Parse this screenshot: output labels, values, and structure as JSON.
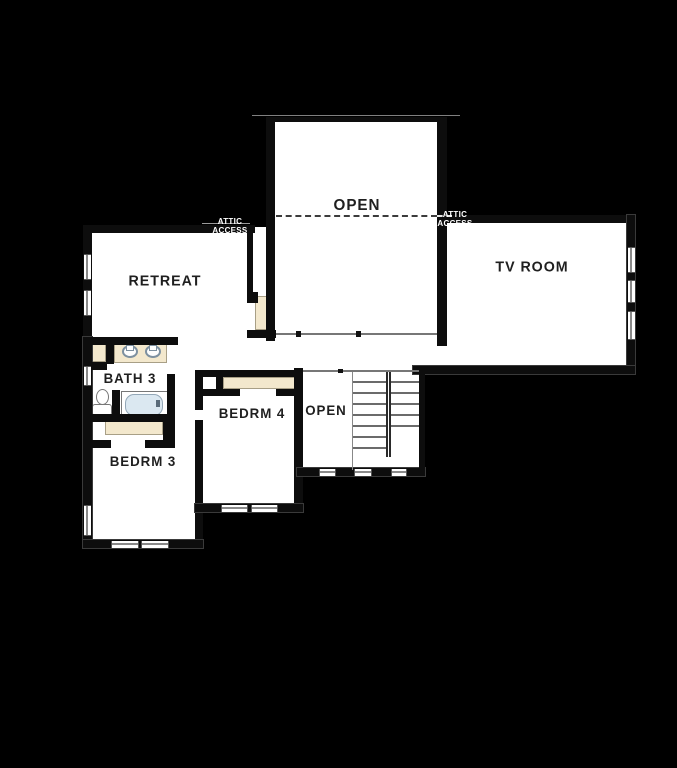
{
  "plan": {
    "type": "floor-plan-second-story",
    "colors": {
      "background": "#000000",
      "floor": "#ffffff",
      "wall": "#0d0d0d",
      "trim_beige": "#f3e8cd",
      "tub_fill": "#dbe8f1",
      "fixture_line": "#7d90a0"
    },
    "rooms": [
      {
        "id": "open-upper",
        "label": "OPEN"
      },
      {
        "id": "tv-room",
        "label": "TV ROOM"
      },
      {
        "id": "retreat",
        "label": "RETREAT"
      },
      {
        "id": "bath-3",
        "label": "BATH 3"
      },
      {
        "id": "bedroom-4",
        "label": "BEDRM 4"
      },
      {
        "id": "open-stairwell",
        "label": "OPEN"
      },
      {
        "id": "bedroom-3",
        "label": "BEDRM 3"
      }
    ],
    "annotations": [
      {
        "id": "attic-access-left",
        "line1": "ATTIC",
        "line2": "ACCESS"
      },
      {
        "id": "attic-access-right",
        "line1": "ATTIC",
        "line2": "ACCESS"
      }
    ]
  }
}
